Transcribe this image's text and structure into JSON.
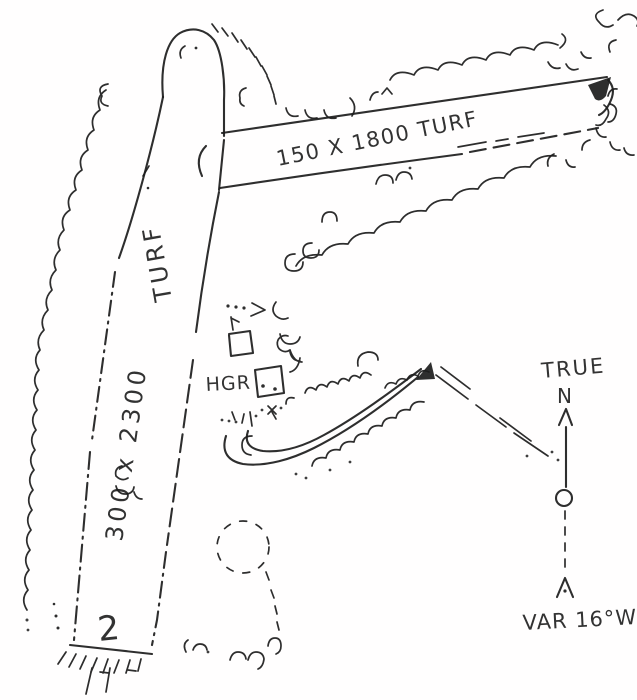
{
  "colors": {
    "ink": "#1c1c1c",
    "paper": "#fffefe"
  },
  "runways": {
    "horizontal": {
      "label": "150 X 1800 TURF"
    },
    "vertical": {
      "surface_label": "TURF",
      "dimensions_label": "300 x 2300",
      "runway_number": "2"
    }
  },
  "hangar": {
    "label": "HGR"
  },
  "north_indicator": {
    "line1": "TRUE",
    "line2": "N",
    "variation": "VAR 16°W"
  }
}
